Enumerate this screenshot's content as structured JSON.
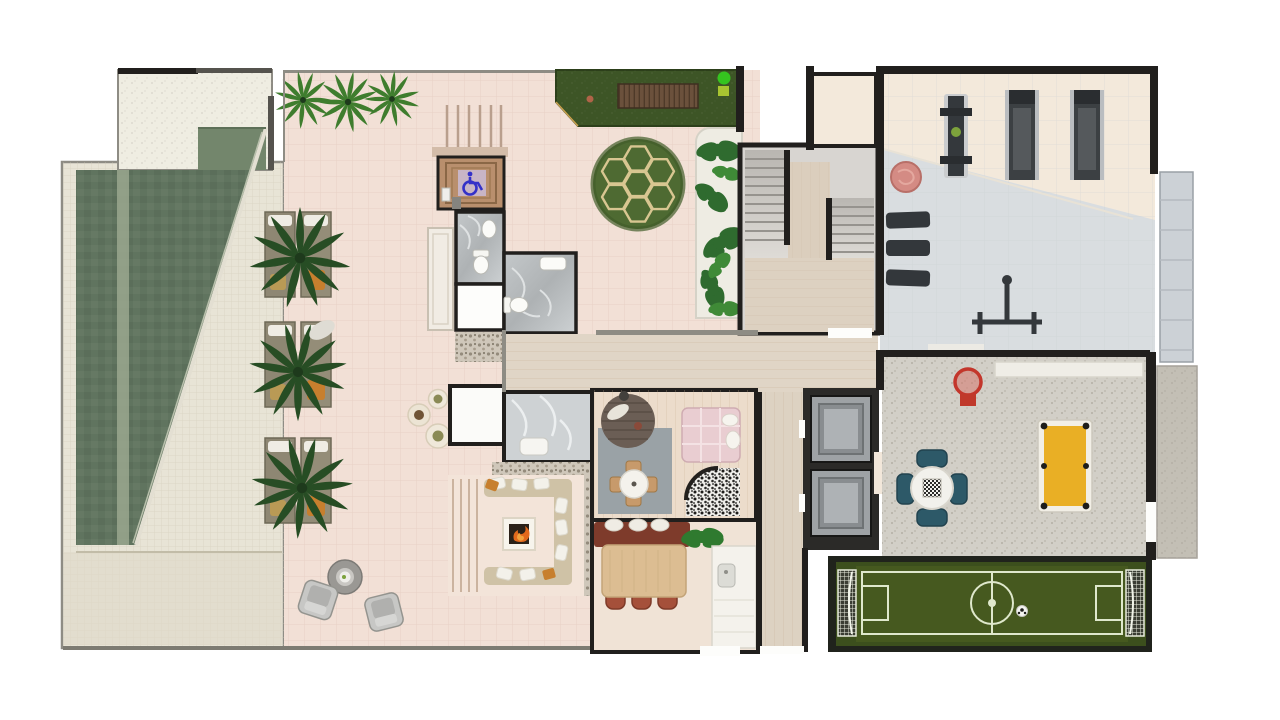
{
  "meta": {
    "title": "Rooftop amenity floor plan — rendered top view"
  },
  "colors": {
    "wall": "#211f1d",
    "wall_light": "#8e8c84",
    "terrace": "#f2e0d6",
    "terrace_grid": "#dcc0b2",
    "deck": "#e8e4d6",
    "deck_grid": "#cfc9b6",
    "deck_speckle": "#efede2",
    "pool": "#5f7460",
    "pool_dark": "#5569557",
    "pool_lane": "#9aa78e",
    "pool_step": "#73866c",
    "garden": "#3d5526",
    "wood_slats": "#6b513c",
    "hedge": "#4e6a32",
    "hedge_line": "#d8c691",
    "planter_gravel": "#eeece3",
    "plant_green": "#2f6b2f",
    "hall_wood": "#e0d5c6",
    "stair_gray": "#cfccc8",
    "stair_wood": "#dbcebd",
    "marble_dark": "#b9bdbf",
    "marble_light": "#ced2d4",
    "wc_wood": "#b98f6d",
    "accessible_blue": "#3431c8",
    "gym_cream": "#f3e9db",
    "gym_gray": "#d9dde0",
    "equipment": "#34383c",
    "pouf_pink": "#d48b84",
    "concrete": "#d2cfc7",
    "elevator_car": "#9ea2a5",
    "shaft": "#2b2a28",
    "field_green": "#3c4f1d",
    "pitch_green": "#4a6124",
    "field_line": "#dfe8cc",
    "billiard_yellow": "#e9af25",
    "game_chair_teal": "#2d5968",
    "sofa_beige": "#cfc2a6",
    "cushion_white": "#f3f1ea",
    "accent_orange": "#c77f2e",
    "fire_orange": "#e2691c",
    "island_red": "#7e3b2b",
    "chair_terracotta": "#a5503a",
    "dining_wood": "#dcbd92",
    "daybed_pink": "#e9cdd1",
    "hoop_red": "#c3362b",
    "kitchen_white": "#f4f2ec",
    "bench_white": "#efede6",
    "spot_green": "#35c41f"
  },
  "areas": {
    "pool": {
      "name": "Swimming pool"
    },
    "deck": {
      "name": "Pool deck"
    },
    "loungers": {
      "name": "Sun lounger bays with palms"
    },
    "terrace": {
      "name": "Open terrace"
    },
    "garden": {
      "name": "Roof garden strip with timber deck"
    },
    "hedge": {
      "name": "Circular hedge feature"
    },
    "planter": {
      "name": "Gravel planter bed"
    },
    "wc": {
      "name": "Accessible washroom"
    },
    "bathrooms": {
      "name": "Washrooms"
    },
    "shower": {
      "name": "Shower room"
    },
    "firepit": {
      "name": "Sunken fire-pit lounge"
    },
    "playroom": {
      "name": "Playroom"
    },
    "dining": {
      "name": "Dining room and kitchen"
    },
    "hall": {
      "name": "Hallway"
    },
    "stairs": {
      "name": "Stair core"
    },
    "gym": {
      "name": "Fitness room"
    },
    "elevators": {
      "name": "Elevator bank"
    },
    "gameroom": {
      "name": "Games room"
    },
    "field": {
      "name": "Mini soccer pitch"
    },
    "balcony": {
      "name": "Perimeter balcony strip"
    }
  },
  "objects": {
    "palm": "palm-plant",
    "lounger": "sun-lounger",
    "armchair": "armchair",
    "coffee_table": "coffee-table",
    "pots": "planter-pots",
    "fireplace": "fire-pit",
    "sofa": "u-shaped-sofa",
    "dining_table": "dining-table",
    "island": "kitchen-island",
    "sink": "kitchen-sink",
    "toilet": "toilet",
    "basin": "wash-basin",
    "daybed": "daybed",
    "play_table": "kids-table",
    "round_rug": "round-platform-rug",
    "treadmill": "treadmill",
    "multigym": "weight-machine",
    "mats": "exercise-mats",
    "pouf": "round-pouf",
    "rack": "squat-rack",
    "elevator": "elevator-car",
    "hoop": "basketball-hoop",
    "game_table": "checkers-table",
    "pool_table": "billiard-table",
    "goal": "soccer-goal",
    "ball": "soccer-ball",
    "deck_bench": "timber-deck-bench",
    "wheelchair": "wheelchair-accessible-icon"
  }
}
